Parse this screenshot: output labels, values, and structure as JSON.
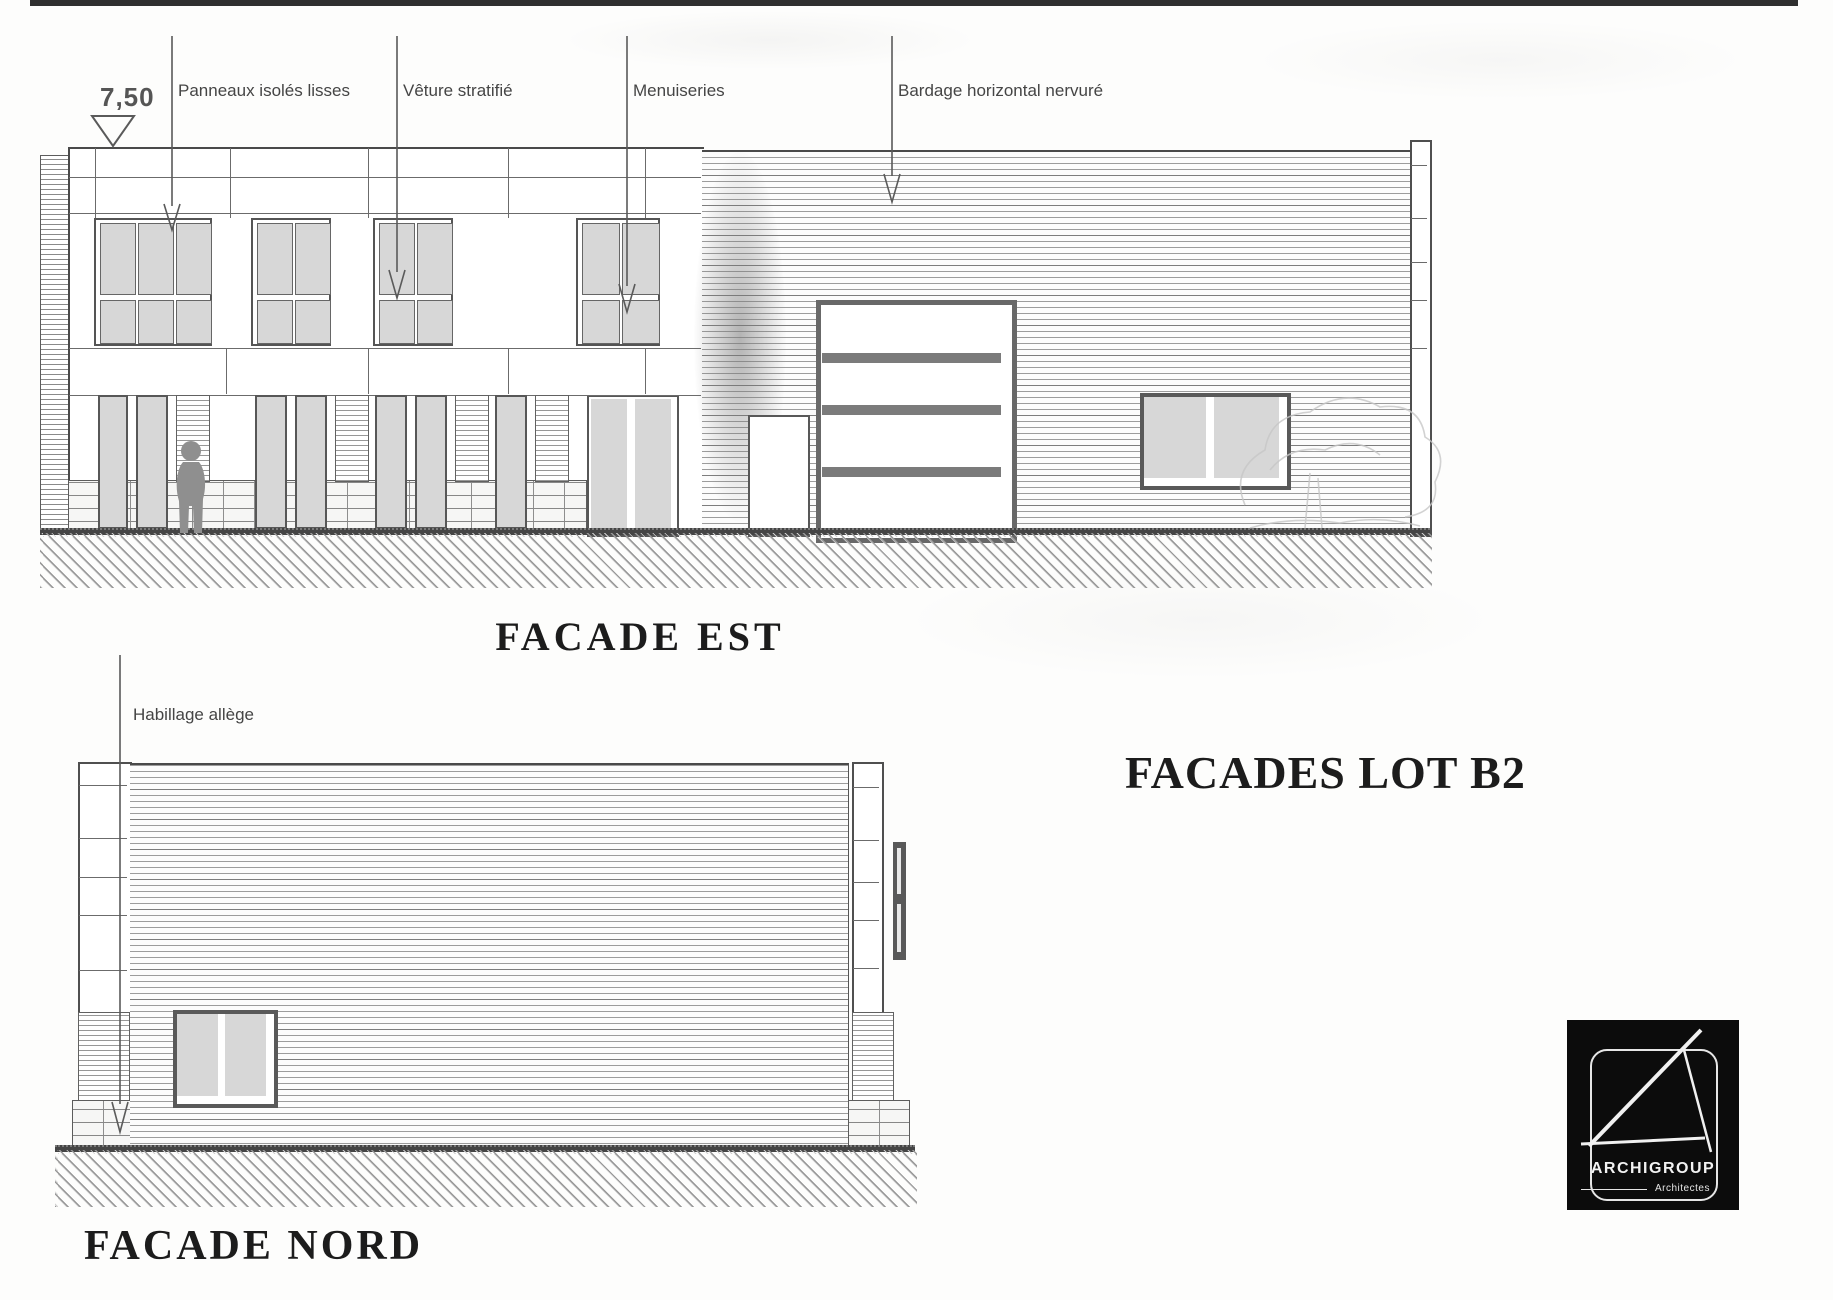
{
  "page": {
    "topbar_color": "#2f2f2f",
    "background": "#fdfdfc"
  },
  "level_marker": {
    "value": "7,50",
    "icon": "level-triangle-icon"
  },
  "annotations": {
    "panneaux": {
      "l1": "Panneaux isolés lisses",
      "l2": "PROMPLAN",
      "l3": "OPALE 4936"
    },
    "veture": {
      "l1": "Vêture stratifié",
      "l2": "Funder Max",
      "l3": "\"Vert Jaunâtre\" 0725"
    },
    "menuiseries": {
      "l1": "Menuiseries",
      "l2": "nuancier Technal",
      "l3": "noir profond RAL 9005 S"
    },
    "bardage": {
      "l1": "Bardage horizontal nervuré",
      "l2": "ARVAL-HACIERBA 5.180.44 HB",
      "l3": "\"Titanium\" 4959  RAL 9007"
    },
    "habillage": {
      "l1": "Habillage allège",
      "l2": "pierre de parement"
    }
  },
  "titles": {
    "est": "FACADE EST",
    "nord": "FACADE NORD",
    "sheet": "FACADES LOT B2"
  },
  "logo": {
    "name": "ARCHIGROUP",
    "subtitle": "Architectes",
    "icon": "drafting-triangle-icon"
  },
  "colors": {
    "line": "#4a4a4a",
    "glass": "#d7d7d7",
    "hatch": "#8f8f8f",
    "annotation_text": "#454545",
    "title_text": "#1c1c1c",
    "logo_bg": "#0c0c0c"
  }
}
